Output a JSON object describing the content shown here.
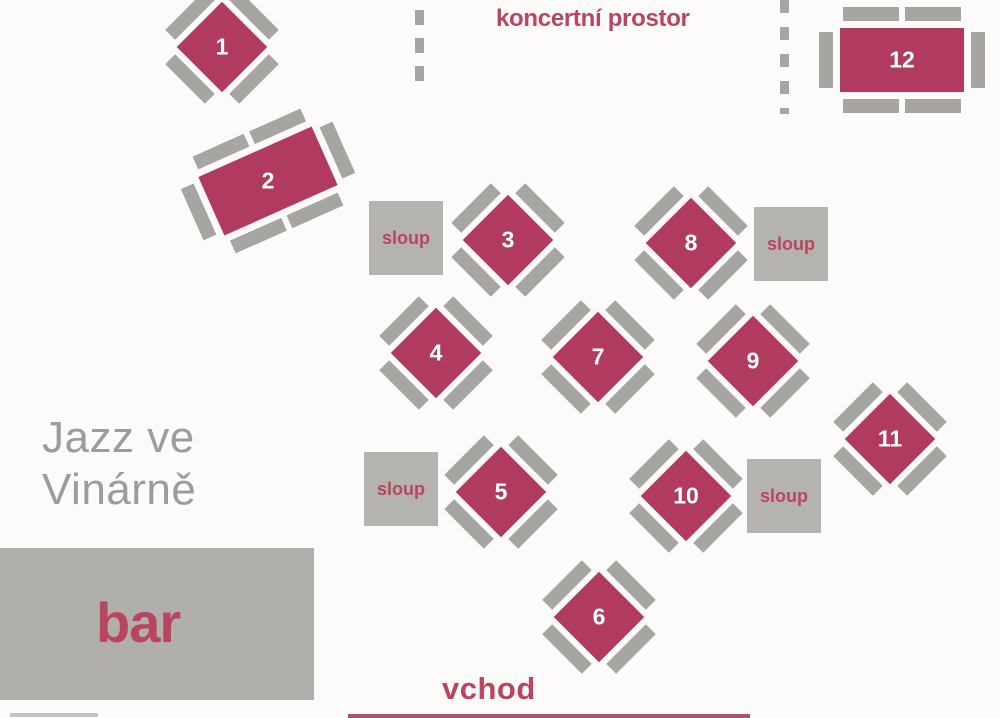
{
  "title": {
    "line1": "Jazz ve",
    "line2": "Vinárně"
  },
  "labels": {
    "koncertni": "koncertní prostor",
    "vchod": "vchod",
    "bar": "bar",
    "sloup": "sloup"
  },
  "colors": {
    "background": "#fcfbf9",
    "table_fill": "#b13b5e",
    "chair_fill": "#a6a5a2",
    "pillar_fill": "#b5b3b0",
    "bar_fill": "#b1afac",
    "accent_text": "#b9455f",
    "title_gray": "#9c9c9c",
    "number_color": "#ffffff"
  },
  "tables": [
    {
      "n": "1",
      "shape": "diamond",
      "cx": 222,
      "cy": 47,
      "angle": 0
    },
    {
      "n": "2",
      "shape": "rect",
      "cx": 268,
      "cy": 181,
      "angle": -24
    },
    {
      "n": "3",
      "shape": "diamond",
      "cx": 508,
      "cy": 240,
      "angle": 0
    },
    {
      "n": "4",
      "shape": "diamond",
      "cx": 436,
      "cy": 353,
      "angle": 0
    },
    {
      "n": "5",
      "shape": "diamond",
      "cx": 501,
      "cy": 492,
      "angle": 0
    },
    {
      "n": "6",
      "shape": "diamond",
      "cx": 599,
      "cy": 617,
      "angle": 0
    },
    {
      "n": "7",
      "shape": "diamond",
      "cx": 598,
      "cy": 357,
      "angle": 0
    },
    {
      "n": "8",
      "shape": "diamond",
      "cx": 691,
      "cy": 243,
      "angle": 0
    },
    {
      "n": "9",
      "shape": "diamond",
      "cx": 753,
      "cy": 361,
      "angle": 0
    },
    {
      "n": "10",
      "shape": "diamond",
      "cx": 686,
      "cy": 496,
      "angle": 0
    },
    {
      "n": "11",
      "shape": "diamond",
      "cx": 890,
      "cy": 439,
      "angle": 0
    },
    {
      "n": "12",
      "shape": "rect",
      "cx": 902,
      "cy": 60,
      "angle": 0
    }
  ],
  "pillars": [
    {
      "x": 369,
      "y": 201
    },
    {
      "x": 754,
      "y": 207
    },
    {
      "x": 364,
      "y": 452
    },
    {
      "x": 747,
      "y": 459
    }
  ]
}
